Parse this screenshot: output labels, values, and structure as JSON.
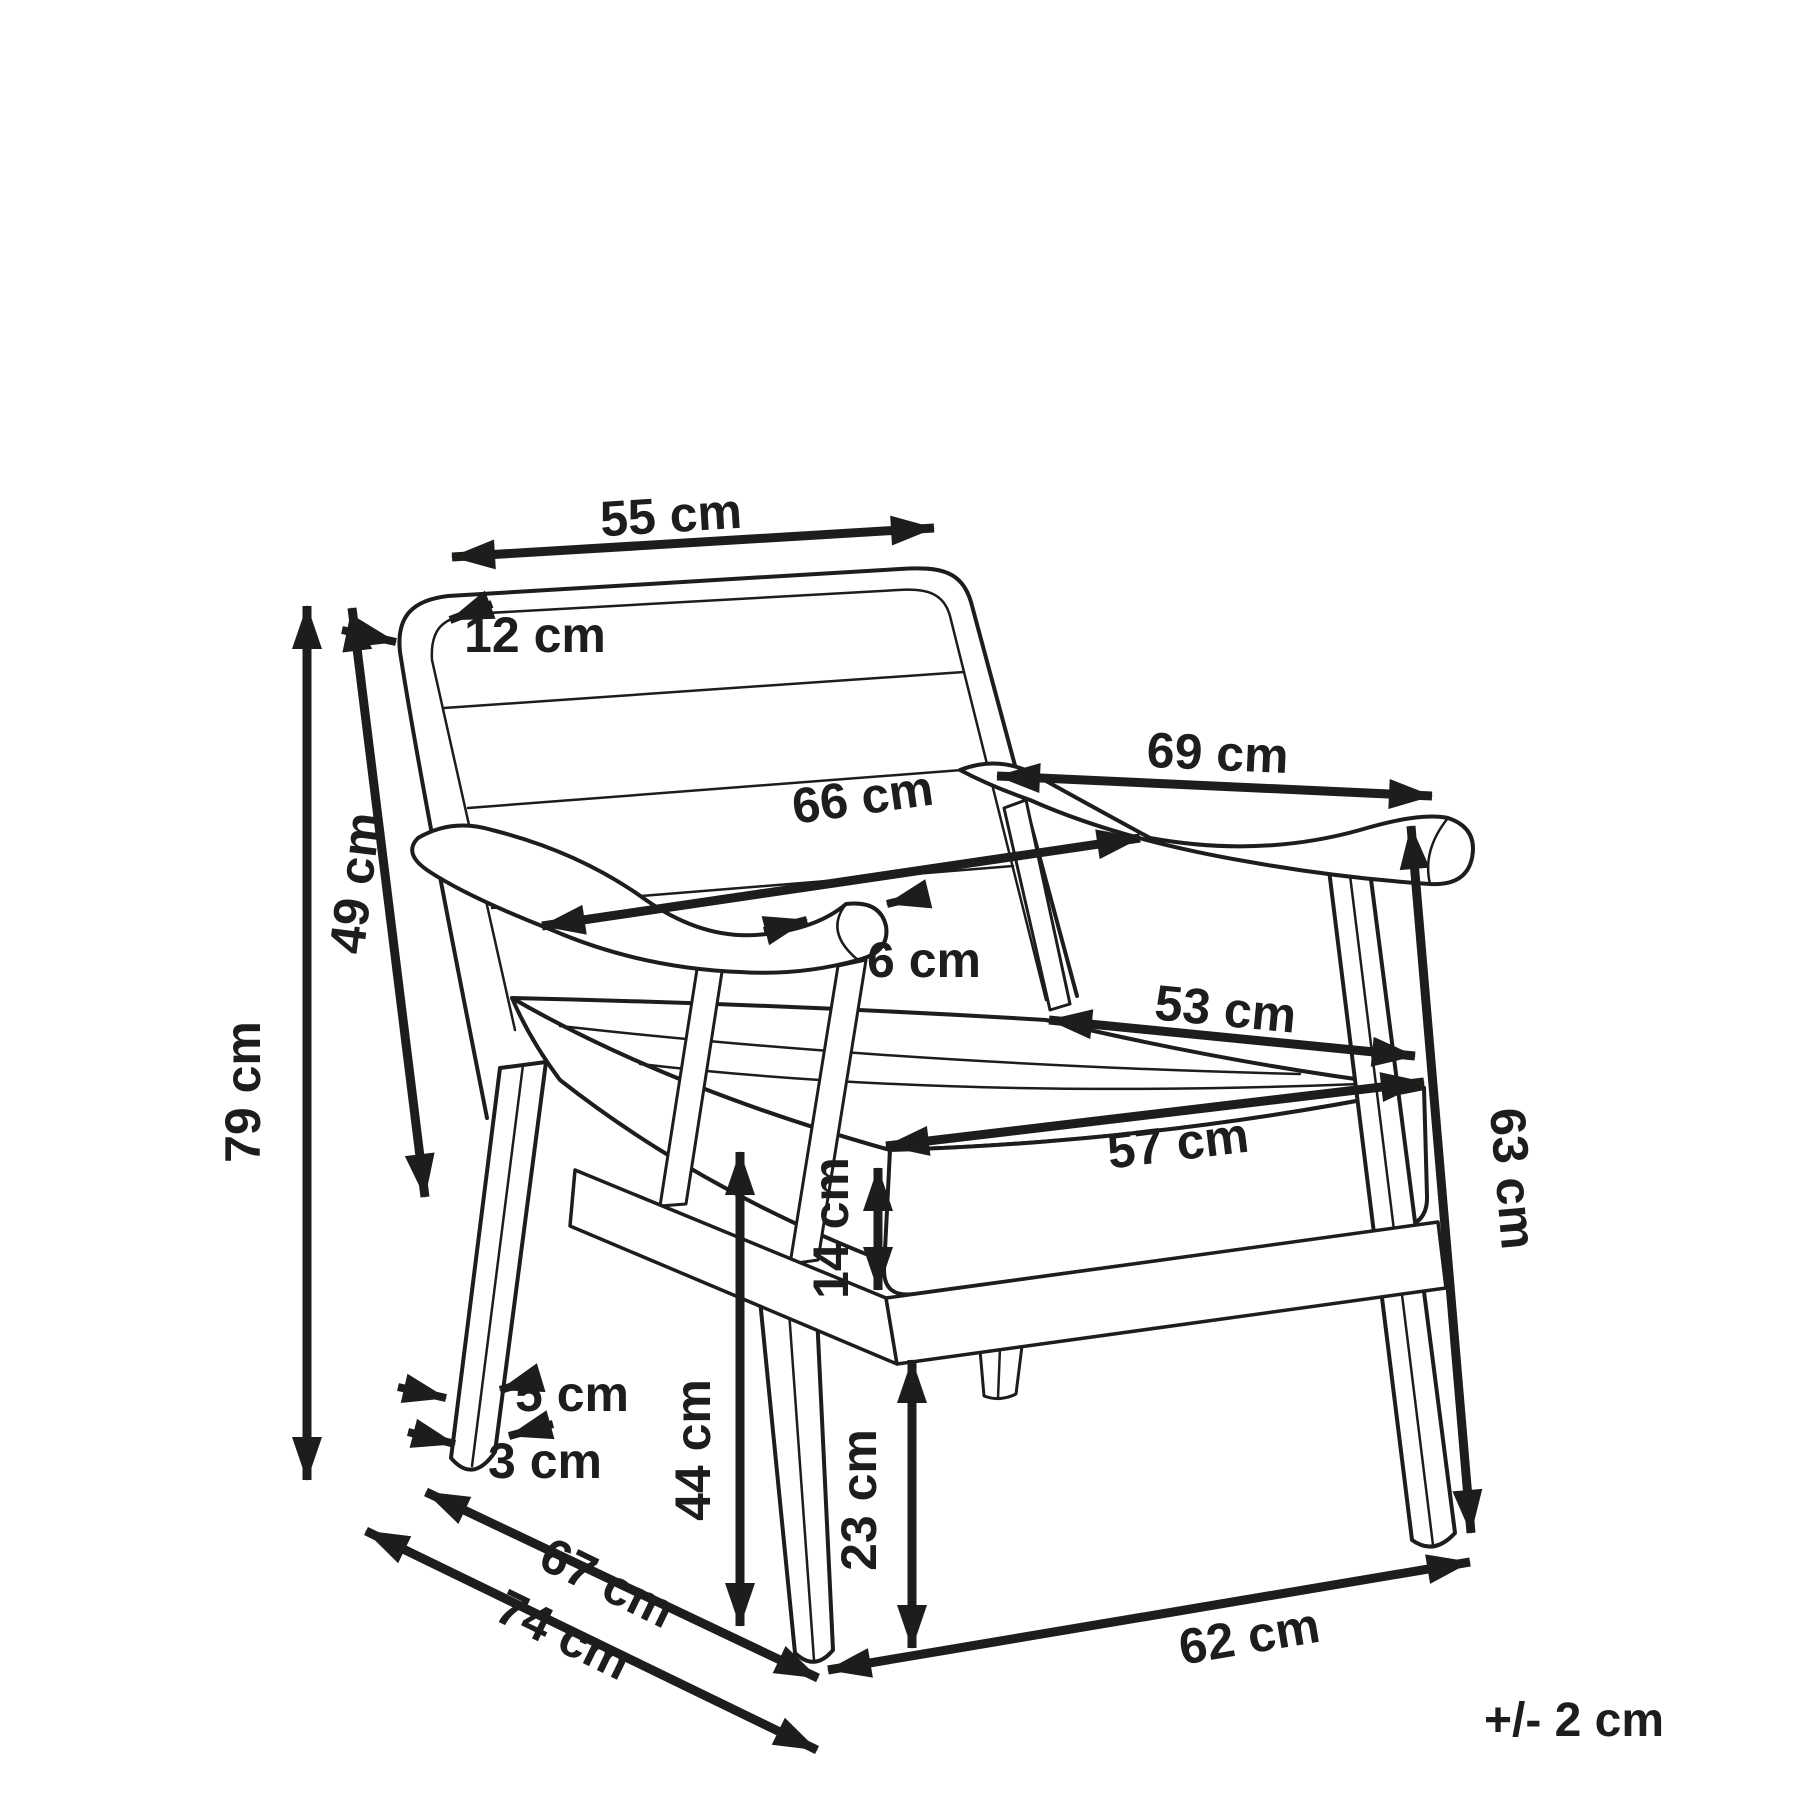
{
  "diagram": {
    "type": "furniture-dimension-diagram",
    "subject": "armchair line drawing, three-quarter perspective view",
    "unit": "cm",
    "tolerance_note": "+/- 2 cm",
    "dimensions": {
      "backrest_top_width": {
        "value": 55,
        "label": "55 cm"
      },
      "backrest_thickness": {
        "value": 12,
        "label": "12 cm"
      },
      "backrest_diagonal_height": {
        "value": 49,
        "label": "49 cm"
      },
      "overall_height": {
        "value": 79,
        "label": "79 cm"
      },
      "armrest_front_to_back": {
        "value": 69,
        "label": "69 cm"
      },
      "armrest_inner_span": {
        "value": 66,
        "label": "66 cm"
      },
      "armrest_width": {
        "value": 6,
        "label": "6 cm"
      },
      "seat_depth": {
        "value": 53,
        "label": "53 cm"
      },
      "seat_front_width": {
        "value": 57,
        "label": "57 cm"
      },
      "cushion_thickness": {
        "value": 14,
        "label": "14 cm"
      },
      "armrest_height": {
        "value": 63,
        "label": "63 cm"
      },
      "seat_height": {
        "value": 44,
        "label": "44 cm"
      },
      "leg_width_top": {
        "value": 5,
        "label": "5 cm"
      },
      "leg_width_bottom": {
        "value": 3,
        "label": "3 cm"
      },
      "under_seat_clearance": {
        "value": 23,
        "label": "23 cm"
      },
      "side_depth_inner": {
        "value": 67,
        "label": "67 cm"
      },
      "overall_depth": {
        "value": 74,
        "label": "74 cm"
      },
      "front_width": {
        "value": 62,
        "label": "62 cm"
      }
    }
  }
}
